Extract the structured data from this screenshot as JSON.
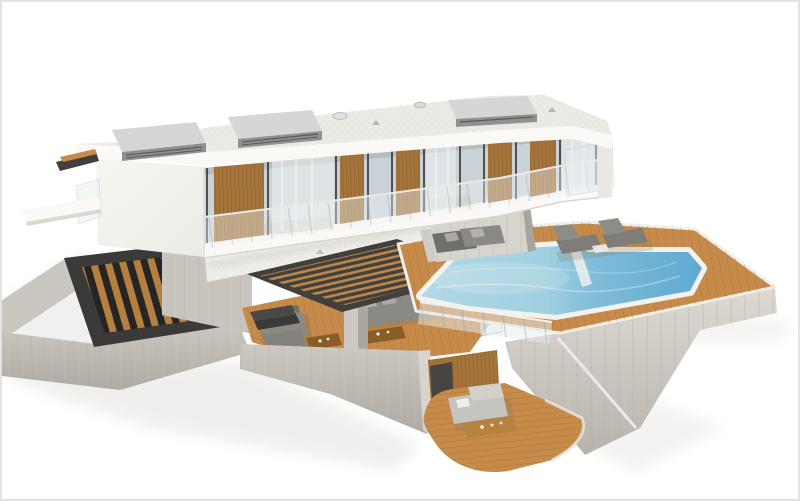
{
  "scene": {
    "type": "3d-architectural-render",
    "description": "3D rendering of a modern two-story white house with a flat roof, rooftop vent boxes, a glass facade with wooden slat screens and glass balcony railings, a cantilevered upper floor over a concrete base, a wooden pool deck with a blue swimming pool and sun loungers, outdoor lounge sofas, a louvered pergola, an external staircase with wooden treads, and a sunken lower terrace with a daybed, isolated on a white background",
    "objects": [
      "modern house",
      "flat roof with vent boxes",
      "glass facade with wooden slat screens",
      "glass balcony railing",
      "concrete base",
      "external staircase with wooden treads",
      "louvered pergola",
      "outdoor sofa sets",
      "swimming pool",
      "wooden pool deck",
      "sun loungers",
      "sunken lounge terrace",
      "daybed"
    ]
  },
  "colors": {
    "background": "#ffffff",
    "frame_border": "#e3e3e3",
    "roof_surface": "#eceae5",
    "fascia_white": "#faf9f6",
    "wall_white": "#f3f1ec",
    "gravel_white": "#f0eeea",
    "glass_blue": "#c9d3d7",
    "curtain_white": "#eef0f0",
    "mullion_dark": "#3a3a38",
    "wood_screen": "#a4743a",
    "deck_wood": "#c68b4a",
    "coping_white": "#f3f2ef",
    "pool_shallow": "#b3d8e4",
    "pool_deep": "#5fa9d1",
    "concrete_light": "#d7d3cd",
    "concrete_mid": "#c2beb7",
    "concrete_dark": "#a8a49d",
    "pergola_dark": "#403f3d",
    "stair_dark": "#3b3a38",
    "sofa_gray": "#8a8984",
    "sofa_gray_dark": "#706f6a",
    "cushion_light": "#b5b3ae",
    "daybed_light": "#c6c4bf",
    "lounger_gray": "#7e7d78",
    "vent_top": "#d6d6d4",
    "vent_side": "#90908e",
    "railing_glass": "#e7eef0",
    "shadow_soft": "#ececea"
  }
}
